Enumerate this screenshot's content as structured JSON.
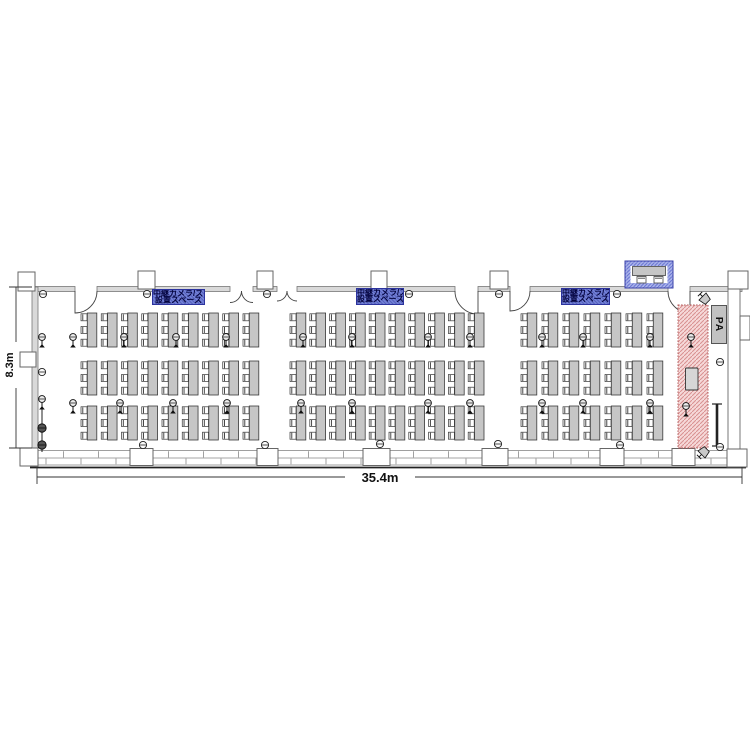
{
  "floorplan": {
    "dim_width": "35.4m",
    "dim_height": "8.3m",
    "pa_label": "PA",
    "zones": [
      {
        "line1": "中継カメラ/スクリーン",
        "line2": "設置スペース"
      },
      {
        "line1": "中継カメラ/スクリーン",
        "line2": "設置スペース"
      },
      {
        "line1": "中継カメラ/スクリーン",
        "line2": "設置スペース"
      }
    ],
    "colors": {
      "table_fill": "#c6c6c6",
      "wall_fill": "#d9d9d9",
      "zone_fill": "#7381d8",
      "zone_border": "#2c339e",
      "stage_fill": "#f6d9d9",
      "stage_hatch": "#d89090",
      "booth_fill": "#aab3ea",
      "booth_border": "#3a41a8"
    },
    "blocks": [
      {
        "x": 81,
        "cols": 9,
        "pitch": 20.25
      },
      {
        "x": 290,
        "cols": 10,
        "pitch": 19.8
      },
      {
        "x": 521,
        "cols": 7,
        "pitch": 21
      }
    ],
    "row_ys": [
      313,
      361,
      406
    ],
    "unit": {
      "chair_w": 6,
      "chair_h": 7,
      "table_w": 9.5,
      "table_h": 34,
      "table_dx": 6.3,
      "chair_ys": [
        0.8,
        13.5,
        26.2
      ]
    },
    "walls": {
      "top_segments": [
        [
          35,
          75
        ],
        [
          97,
          230
        ],
        [
          253,
          277
        ],
        [
          297,
          455
        ],
        [
          478,
          510
        ],
        [
          530,
          668
        ],
        [
          690,
          742
        ]
      ]
    },
    "pillars": [
      [
        18,
        272,
        17,
        19
      ],
      [
        138,
        271,
        17,
        18
      ],
      [
        257,
        271,
        16,
        18
      ],
      [
        371,
        271,
        16,
        18
      ],
      [
        490,
        271,
        18,
        18
      ],
      [
        728,
        271,
        20,
        18
      ],
      [
        20,
        352,
        16,
        15
      ],
      [
        740,
        316,
        10,
        24
      ],
      [
        20,
        448,
        18,
        18
      ],
      [
        727,
        449,
        20,
        18
      ],
      [
        130,
        448.5,
        23,
        17
      ],
      [
        257,
        448.5,
        21,
        17
      ],
      [
        363,
        448.5,
        27,
        17
      ],
      [
        482,
        448.5,
        26,
        17
      ],
      [
        600,
        448.5,
        24,
        17
      ],
      [
        672,
        448.5,
        23,
        17
      ]
    ],
    "doors": [
      {
        "t": "s",
        "x1": 75,
        "x2": 97,
        "h": "left"
      },
      {
        "t": "d",
        "x1": 230,
        "x2": 253
      },
      {
        "t": "d",
        "x1": 277,
        "x2": 297
      },
      {
        "t": "s",
        "x1": 455,
        "x2": 478,
        "h": "right"
      },
      {
        "t": "s",
        "x1": 510,
        "x2": 530,
        "h": "left"
      },
      {
        "t": "s",
        "x1": 668,
        "x2": 690,
        "h": "right"
      }
    ],
    "microphones": [
      [
        42,
        337
      ],
      [
        73,
        337
      ],
      [
        124,
        337
      ],
      [
        176,
        337
      ],
      [
        226,
        337
      ],
      [
        303,
        337
      ],
      [
        352,
        337
      ],
      [
        428,
        337
      ],
      [
        470,
        337
      ],
      [
        542,
        337
      ],
      [
        583,
        337
      ],
      [
        650,
        337
      ],
      [
        691,
        337
      ],
      [
        42,
        399
      ],
      [
        73,
        403
      ],
      [
        120,
        403
      ],
      [
        173,
        403
      ],
      [
        227,
        403
      ],
      [
        301,
        403
      ],
      [
        352,
        403
      ],
      [
        428,
        403
      ],
      [
        470,
        403
      ],
      [
        542,
        403
      ],
      [
        583,
        403
      ],
      [
        650,
        403
      ],
      [
        686,
        406
      ]
    ],
    "outlets": [
      [
        43,
        294
      ],
      [
        147,
        294
      ],
      [
        267,
        294
      ],
      [
        409,
        294
      ],
      [
        499,
        294
      ],
      [
        617,
        294
      ],
      [
        143,
        445
      ],
      [
        265,
        445
      ],
      [
        380,
        444
      ],
      [
        498,
        444
      ],
      [
        620,
        445
      ],
      [
        720,
        447
      ],
      [
        42,
        372
      ],
      [
        720,
        362
      ]
    ],
    "speakers": [
      {
        "x": 705,
        "y": 299,
        "rot": -45
      },
      {
        "x": 704,
        "y": 452,
        "rot": -135
      }
    ],
    "floor_speakers": [
      [
        42,
        428
      ],
      [
        42,
        445
      ]
    ]
  }
}
